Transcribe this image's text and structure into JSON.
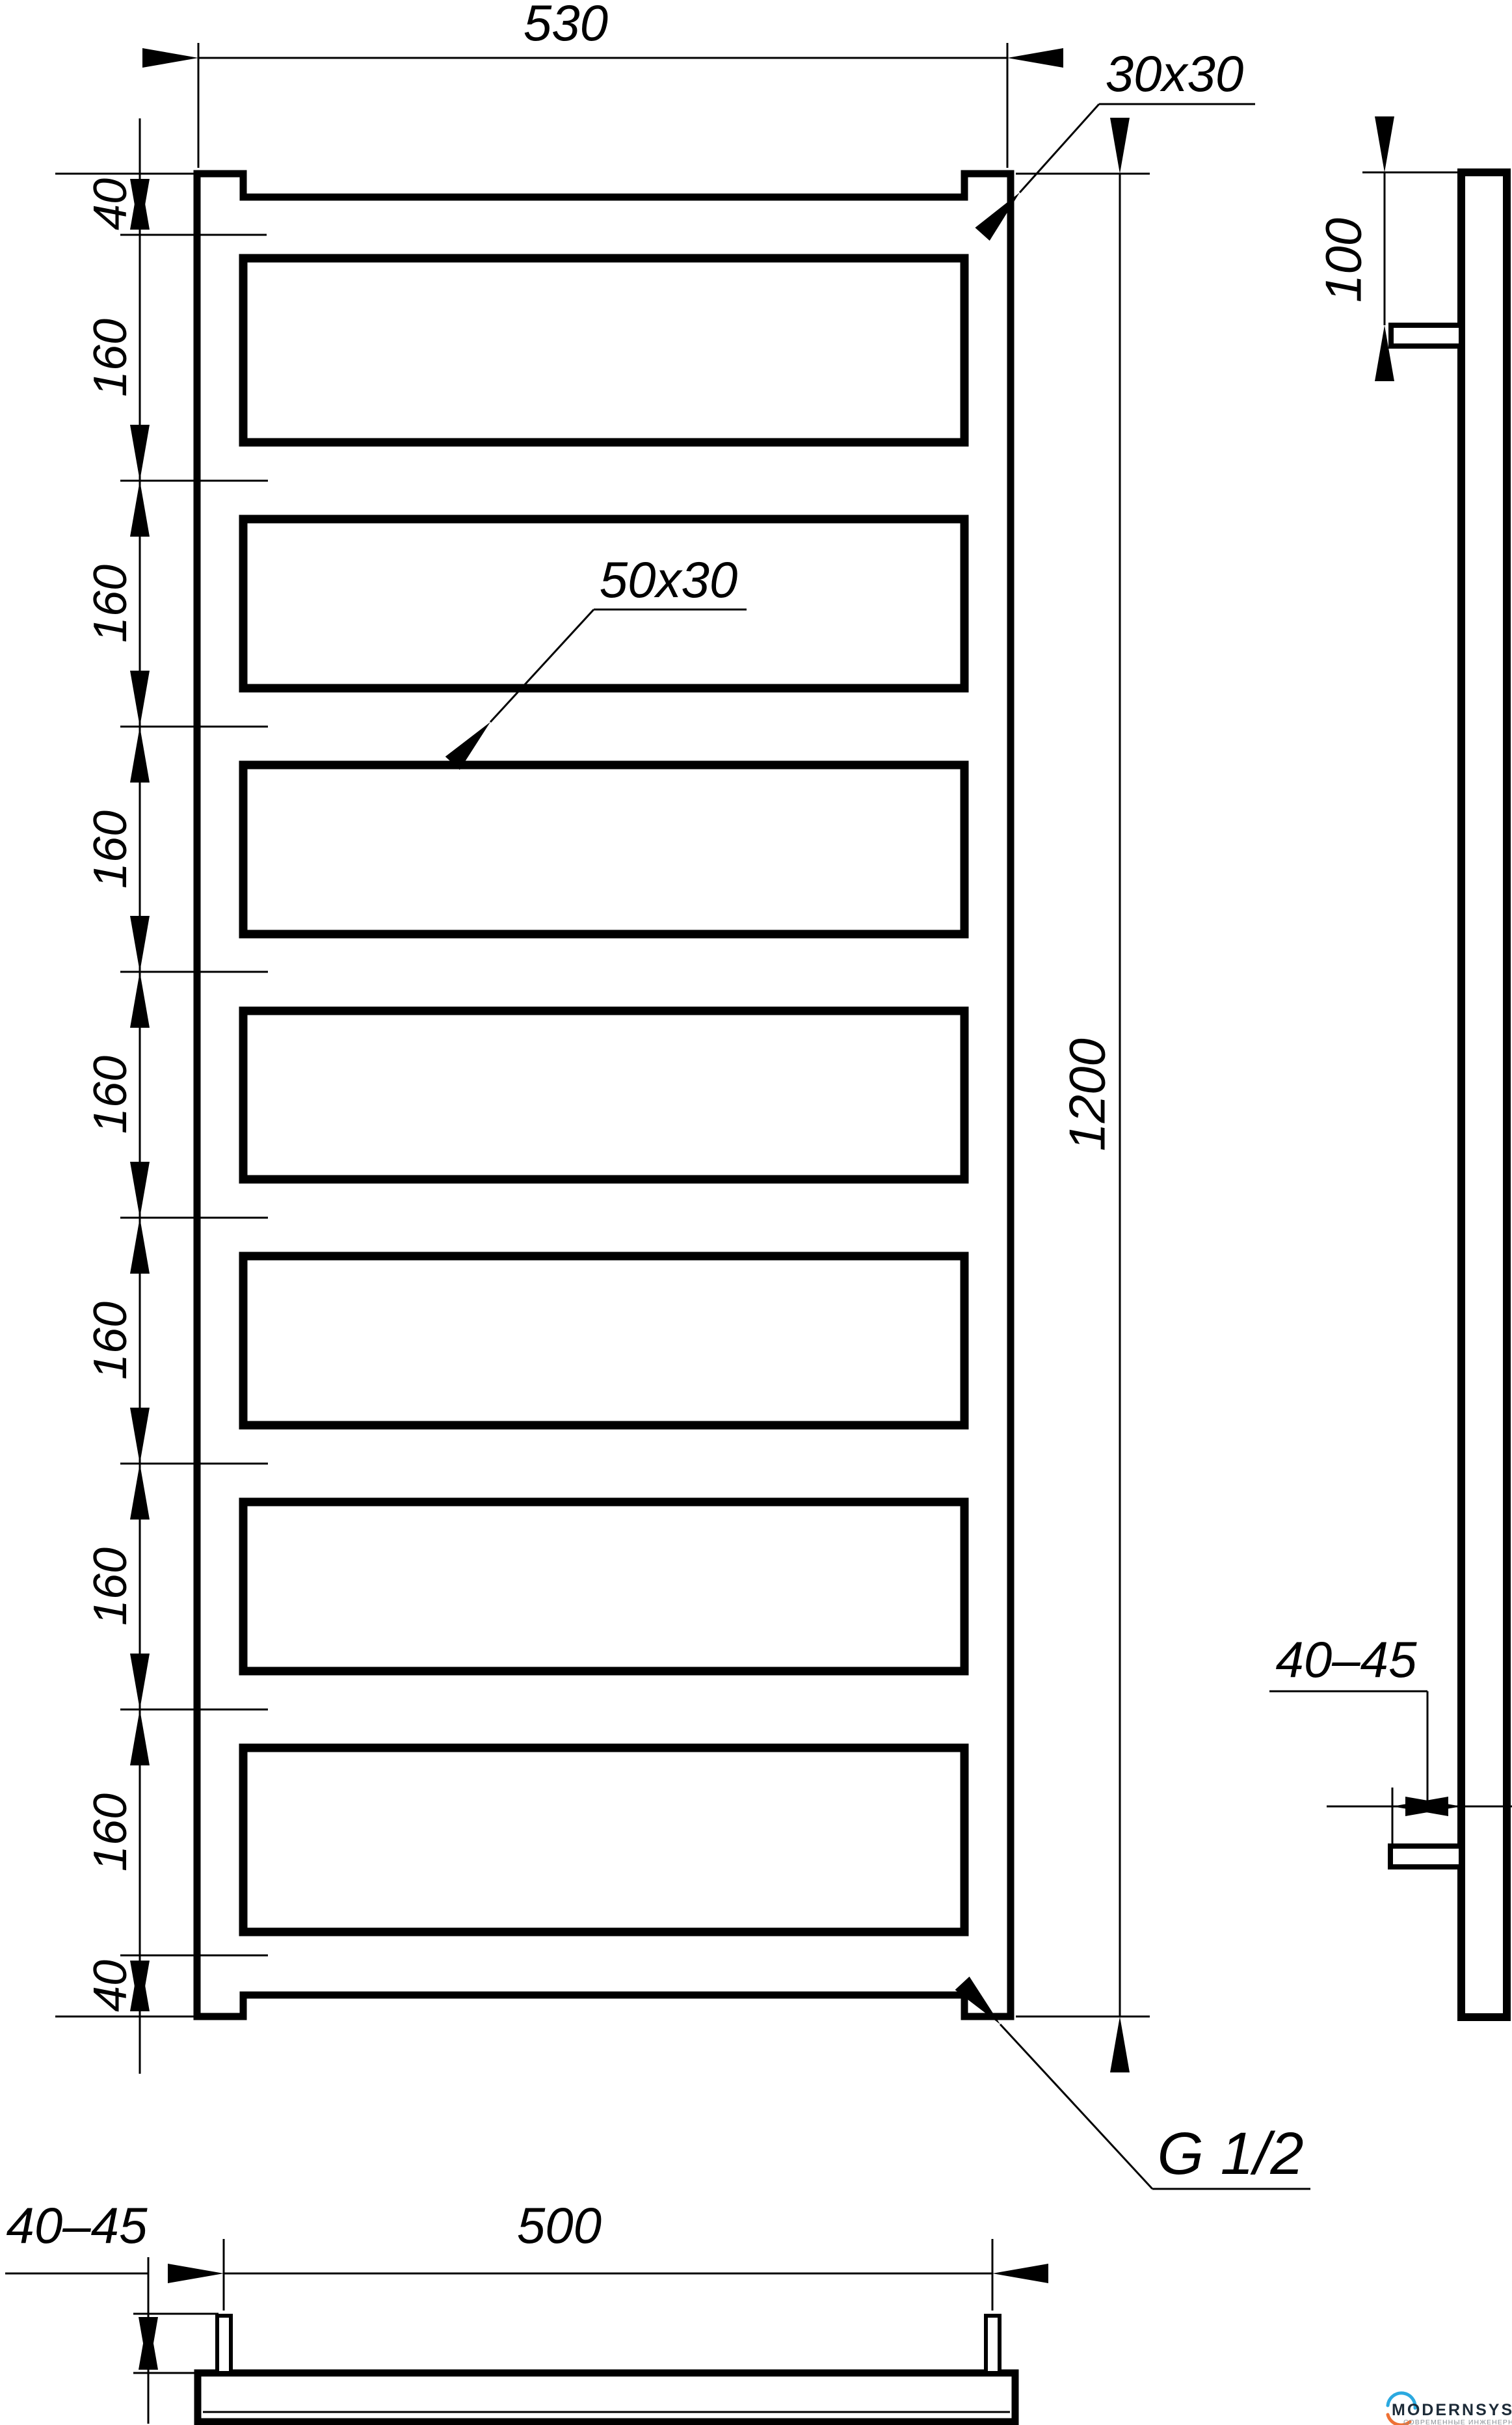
{
  "front_view": {
    "width_label": "530",
    "height_label": "1200",
    "rail_profile_label": "30x30",
    "rung_profile_label": "50x30",
    "thread_label": "G 1/2",
    "left_dims": [
      "40",
      "160",
      "160",
      "160",
      "160",
      "160",
      "160",
      "160",
      "40"
    ]
  },
  "side_view": {
    "bracket_offset_label": "100",
    "wall_distance_label": "40–45"
  },
  "bottom_view": {
    "bracket_spacing_label": "500",
    "wall_distance_label": "40–45"
  },
  "logo": {
    "brand": "MODERNSYS",
    "tagline": "СОВРЕМЕННЫЕ ИНЖЕНЕРНЫЕ СИСТЕМЫ",
    "blue": "#2BA9E0",
    "orange": "#EE7135",
    "text_color": "#1D2B38",
    "tagline_color": "#8A9096"
  }
}
